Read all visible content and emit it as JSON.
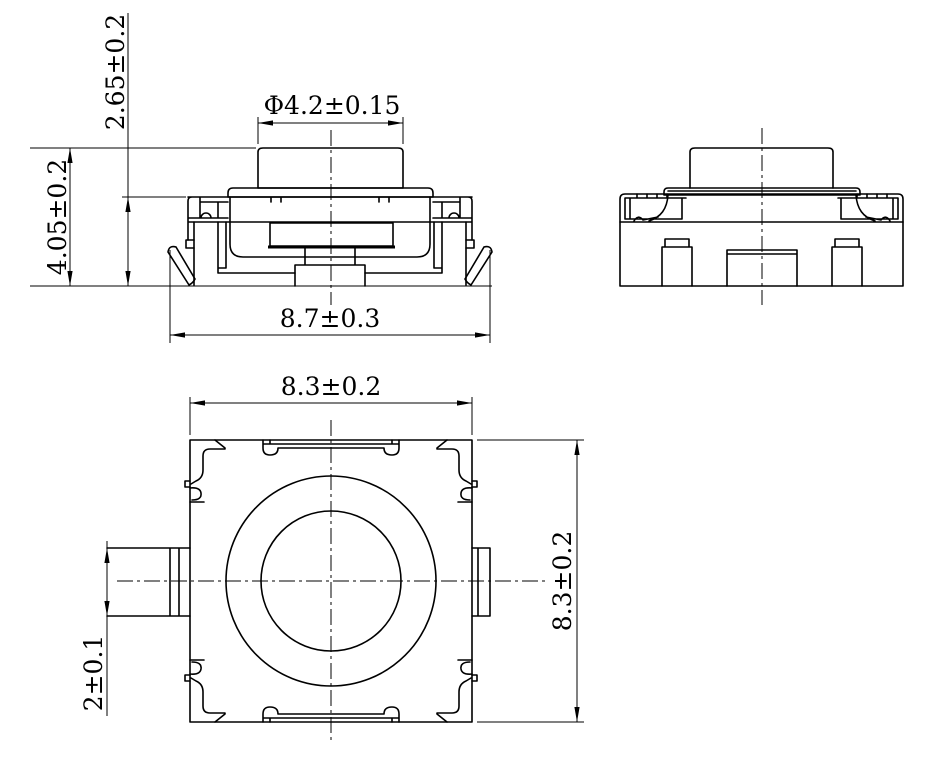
{
  "colors": {
    "background": "#ffffff",
    "line": "#000000"
  },
  "views": {
    "front_view": {
      "dims": {
        "body_height": "2.65±0.2",
        "total_height": "4.05±0.2",
        "actuator_diameter": "Φ4.2±0.15",
        "lead_span": "8.7±0.3"
      }
    },
    "top_view": {
      "dims": {
        "body_width": "8.3±0.2",
        "body_depth": "8.3±0.2",
        "terminal_width": "2±0.1"
      }
    }
  }
}
